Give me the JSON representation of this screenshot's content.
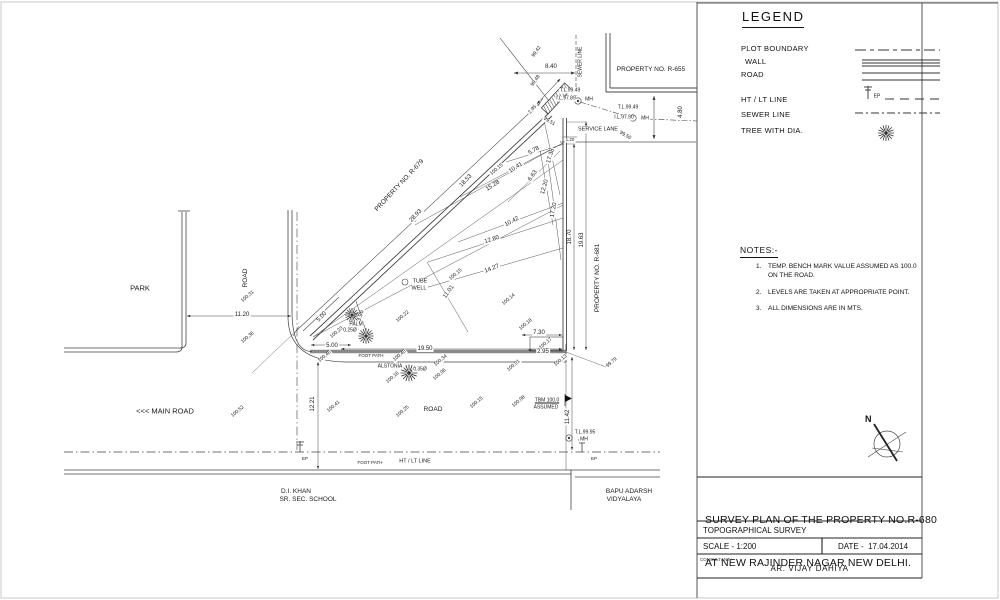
{
  "legend": {
    "title": "LEGEND",
    "items": [
      {
        "label": "PLOT BOUNDARY",
        "symbol": "dashed-line"
      },
      {
        "label": "WALL",
        "symbol": "triple-line"
      },
      {
        "label": "ROAD",
        "symbol": "double-line"
      },
      {
        "label": "HT / LT LINE",
        "symbol": "electric-pole-dash-line"
      },
      {
        "label": "SEWER LINE",
        "symbol": "dash-dot-line"
      },
      {
        "label": "TREE WITH DIA.",
        "symbol": "tree-glyph"
      }
    ],
    "ep_label": "EP"
  },
  "notes": {
    "title": "NOTES:-",
    "items": [
      {
        "num": "1.",
        "text": "TEMP. BENCH MARK VALUE ASSUMED AS 100.0",
        "text2": "ON THE ROAD."
      },
      {
        "num": "2.",
        "text": "LEVELS ARE TAKEN AT APPROPRIATE POINT.",
        "text2": ""
      },
      {
        "num": "3.",
        "text": "ALL DIMENSIONS ARE IN MTS.",
        "text2": ""
      }
    ]
  },
  "compass": {
    "north_label": "N"
  },
  "title_block": {
    "title_line1": "SURVEY PLAN OF THE PROPERTY NO.R-680",
    "title_line2": "AT NEW RAJINDER NAGAR NEW DELHI.",
    "survey_type": "TOPOGRAPHICAL SURVEY",
    "scale": "SCALE - 1:200",
    "date": "DATE -  17.04.2014",
    "consultant_label": "CONSULTANT :-",
    "consultant": "AR. VIJAY DAHIYA"
  },
  "drawing": {
    "labels": [
      {
        "t": "99.42",
        "x": 537,
        "y": 52,
        "r": -55,
        "s": 5
      },
      {
        "t": "8.40",
        "x": 551,
        "y": 67,
        "r": 0,
        "s": 6
      },
      {
        "t": "99.48",
        "x": 536,
        "y": 81,
        "r": -55,
        "s": 5
      },
      {
        "t": "SEWER LINE",
        "x": 581,
        "y": 62,
        "r": -90,
        "s": 5,
        "n": "sewer-line-label"
      },
      {
        "t": "PROPERTY NO. R-655",
        "x": 651,
        "y": 70,
        "r": 0,
        "s": 6.5,
        "n": "property-r655-label"
      },
      {
        "t": "T.L.99.49",
        "x": 570,
        "y": 91,
        "r": 0,
        "s": 5
      },
      {
        "t": "I.L.97.89",
        "x": 566,
        "y": 99,
        "r": 0,
        "s": 5
      },
      {
        "t": "MH",
        "x": 589,
        "y": 100,
        "r": 0,
        "s": 5
      },
      {
        "t": "T.L.99.49",
        "x": 628,
        "y": 108,
        "r": 0,
        "s": 5
      },
      {
        "t": "I.L.97.90",
        "x": 624,
        "y": 118,
        "r": 0,
        "s": 5
      },
      {
        "t": "MH",
        "x": 645,
        "y": 119,
        "r": 0,
        "s": 5
      },
      {
        "t": "99.51",
        "x": 549,
        "y": 122,
        "r": 30,
        "s": 5
      },
      {
        "t": "SERVICE LANE",
        "x": 598,
        "y": 130,
        "r": 0,
        "s": 5.5,
        "n": "service-lane-label"
      },
      {
        "t": "99.50",
        "x": 625,
        "y": 136,
        "r": 30,
        "s": 5
      },
      {
        "t": "4.80",
        "x": 681,
        "y": 112,
        "r": -90,
        "s": 6
      },
      {
        "t": "2.95",
        "x": 533,
        "y": 110,
        "r": -49,
        "s": 5
      },
      {
        "t": "1.20",
        "x": 570,
        "y": 140,
        "r": 0,
        "s": 4.5
      },
      {
        "t": "PROPERTY NO. R-679",
        "x": 400,
        "y": 186,
        "r": -47,
        "s": 6.5,
        "n": "property-r679-label"
      },
      {
        "t": "18.53",
        "x": 466,
        "y": 181,
        "r": -47,
        "s": 6
      },
      {
        "t": "28.93",
        "x": 416,
        "y": 216,
        "r": -47,
        "s": 6
      },
      {
        "t": "5.78",
        "x": 534,
        "y": 151,
        "r": -30,
        "s": 6
      },
      {
        "t": "100.15",
        "x": 497,
        "y": 170,
        "r": -40,
        "s": 5
      },
      {
        "t": "10.41",
        "x": 516,
        "y": 168,
        "r": -33,
        "s": 6
      },
      {
        "t": "15.28",
        "x": 493,
        "y": 186,
        "r": -33,
        "s": 6
      },
      {
        "t": "6.63",
        "x": 533,
        "y": 176,
        "r": -55,
        "s": 6
      },
      {
        "t": "17.38",
        "x": 551,
        "y": 156,
        "r": -74,
        "s": 6
      },
      {
        "t": "12.20",
        "x": 545,
        "y": 187,
        "r": -74,
        "s": 6
      },
      {
        "t": "17.20",
        "x": 554,
        "y": 210,
        "r": -80,
        "s": 6
      },
      {
        "t": "10.42",
        "x": 512,
        "y": 222,
        "r": -28,
        "s": 6
      },
      {
        "t": "12.80",
        "x": 492,
        "y": 240,
        "r": -18,
        "s": 6
      },
      {
        "t": "14.27",
        "x": 492,
        "y": 269,
        "r": -22,
        "s": 6
      },
      {
        "t": "11.01",
        "x": 449,
        "y": 292,
        "r": -55,
        "s": 6
      },
      {
        "t": "100.15",
        "x": 456,
        "y": 275,
        "r": -40,
        "s": 5
      },
      {
        "t": "100.14",
        "x": 509,
        "y": 300,
        "r": -40,
        "s": 5
      },
      {
        "t": "100.22",
        "x": 403,
        "y": 317,
        "r": -40,
        "s": 5
      },
      {
        "t": "TUBE",
        "x": 420,
        "y": 282,
        "r": 0,
        "s": 5.5,
        "n": "tube-well-label"
      },
      {
        "t": "WELL",
        "x": 419,
        "y": 289,
        "r": 0,
        "s": 5.5
      },
      {
        "t": "18.70",
        "x": 570,
        "y": 237,
        "r": -90,
        "s": 6
      },
      {
        "t": "19.63",
        "x": 582,
        "y": 240,
        "r": -90,
        "s": 6
      },
      {
        "t": "PROPERTY NO. R-681",
        "x": 598,
        "y": 278,
        "r": -90,
        "s": 6.5,
        "n": "property-r681-label"
      },
      {
        "t": "5.00",
        "x": 322,
        "y": 317,
        "r": -47,
        "s": 6
      },
      {
        "t": "3.96",
        "x": 361,
        "y": 316,
        "r": -74,
        "s": 6
      },
      {
        "t": "100.23",
        "x": 337,
        "y": 333,
        "r": -40,
        "s": 5
      },
      {
        "t": "PALM",
        "x": 356,
        "y": 325,
        "r": 0,
        "s": 5
      },
      {
        "t": "0.25Ø",
        "x": 350,
        "y": 331,
        "r": 0,
        "s": 5
      },
      {
        "t": "5.00",
        "x": 332,
        "y": 346,
        "r": 0,
        "s": 6
      },
      {
        "t": "100.46",
        "x": 325,
        "y": 357,
        "r": -40,
        "s": 5
      },
      {
        "t": "FOOT PATH",
        "x": 371,
        "y": 356,
        "r": 0,
        "s": 4.5,
        "n": "foot-path-label"
      },
      {
        "t": "100.40",
        "x": 400,
        "y": 356,
        "r": -40,
        "s": 5
      },
      {
        "t": "19.50",
        "x": 425,
        "y": 349,
        "r": 0,
        "s": 6
      },
      {
        "t": "100.34",
        "x": 441,
        "y": 361,
        "r": -40,
        "s": 5
      },
      {
        "t": "ALSTONIA",
        "x": 390,
        "y": 367,
        "r": 0,
        "s": 5
      },
      {
        "t": "0.35Ø",
        "x": 420,
        "y": 370,
        "r": 0,
        "s": 5
      },
      {
        "t": "100.16",
        "x": 393,
        "y": 378,
        "r": -40,
        "s": 5
      },
      {
        "t": "100.06",
        "x": 440,
        "y": 375,
        "r": -40,
        "s": 5
      },
      {
        "t": "100.18",
        "x": 526,
        "y": 325,
        "r": -40,
        "s": 5
      },
      {
        "t": "7.30",
        "x": 539,
        "y": 333,
        "r": 0,
        "s": 6
      },
      {
        "t": "100.17",
        "x": 546,
        "y": 344,
        "r": -40,
        "s": 5
      },
      {
        "t": "2.95",
        "x": 543,
        "y": 352,
        "r": 0,
        "s": 6
      },
      {
        "t": "100.01",
        "x": 514,
        "y": 366,
        "r": -40,
        "s": 5
      },
      {
        "t": "100.13",
        "x": 561,
        "y": 361,
        "r": -40,
        "s": 5
      },
      {
        "t": "99.79",
        "x": 612,
        "y": 363,
        "r": -40,
        "s": 5
      },
      {
        "t": "100.25",
        "x": 403,
        "y": 412,
        "r": -40,
        "s": 5
      },
      {
        "t": "ROAD",
        "x": 433,
        "y": 410,
        "r": 0,
        "s": 6.5,
        "n": "road-label"
      },
      {
        "t": "100.15",
        "x": 477,
        "y": 403,
        "r": -40,
        "s": 5
      },
      {
        "t": "100.08",
        "x": 519,
        "y": 402,
        "r": -40,
        "s": 5
      },
      {
        "t": "TBM 100.0",
        "x": 547,
        "y": 401,
        "r": 0,
        "s": 5,
        "u": 1,
        "n": "tbm-label"
      },
      {
        "t": "ASSUMED",
        "x": 546,
        "y": 408,
        "r": 0,
        "s": 5
      },
      {
        "t": "11.42",
        "x": 568,
        "y": 417,
        "r": -90,
        "s": 6
      },
      {
        "t": "T.L.99.95",
        "x": 585,
        "y": 433,
        "r": 0,
        "s": 5
      },
      {
        "t": "MH",
        "x": 584,
        "y": 440,
        "r": 0,
        "s": 5
      },
      {
        "t": "EP",
        "x": 594,
        "y": 459,
        "r": 0,
        "s": 4.5
      },
      {
        "t": "HT / LT LINE",
        "x": 415,
        "y": 462,
        "r": 0,
        "s": 5.5,
        "n": "ht-lt-line-label"
      },
      {
        "t": "FOOT PATH",
        "x": 370,
        "y": 463,
        "r": 0,
        "s": 4.5
      },
      {
        "t": "EP",
        "x": 305,
        "y": 459,
        "r": 0,
        "s": 4.5
      },
      {
        "t": "PARK",
        "x": 140,
        "y": 288,
        "r": 0,
        "s": 7.5,
        "n": "park-label"
      },
      {
        "t": "ROAD",
        "x": 246,
        "y": 278,
        "r": -90,
        "s": 6.5
      },
      {
        "t": "100.31",
        "x": 248,
        "y": 297,
        "r": -40,
        "s": 5
      },
      {
        "t": "11.20",
        "x": 242,
        "y": 315,
        "r": 0,
        "s": 6
      },
      {
        "t": "100.36",
        "x": 248,
        "y": 338,
        "r": -40,
        "s": 5
      },
      {
        "t": "<<< MAIN ROAD",
        "x": 165,
        "y": 411,
        "r": 0,
        "s": 7.5,
        "n": "main-road-label"
      },
      {
        "t": "100.52",
        "x": 238,
        "y": 412,
        "r": -40,
        "s": 5
      },
      {
        "t": "12.21",
        "x": 313,
        "y": 404,
        "r": -90,
        "s": 6
      },
      {
        "t": "100.41",
        "x": 334,
        "y": 407,
        "r": -40,
        "s": 5
      },
      {
        "t": "D.I. KHAN",
        "x": 296,
        "y": 492,
        "r": 0,
        "s": 6.5,
        "n": "school-label"
      },
      {
        "t": "SR. SEC. SCHOOL",
        "x": 308,
        "y": 500,
        "r": 0,
        "s": 6.5
      },
      {
        "t": "BAPU ADARSH",
        "x": 629,
        "y": 492,
        "r": 0,
        "s": 6.5,
        "n": "vidyalaya-label"
      },
      {
        "t": "VIDYALAYA",
        "x": 624,
        "y": 500,
        "r": 0,
        "s": 6.5
      },
      {
        "t": "EP",
        "x": 877,
        "y": 97,
        "r": 0,
        "s": 5
      }
    ]
  }
}
